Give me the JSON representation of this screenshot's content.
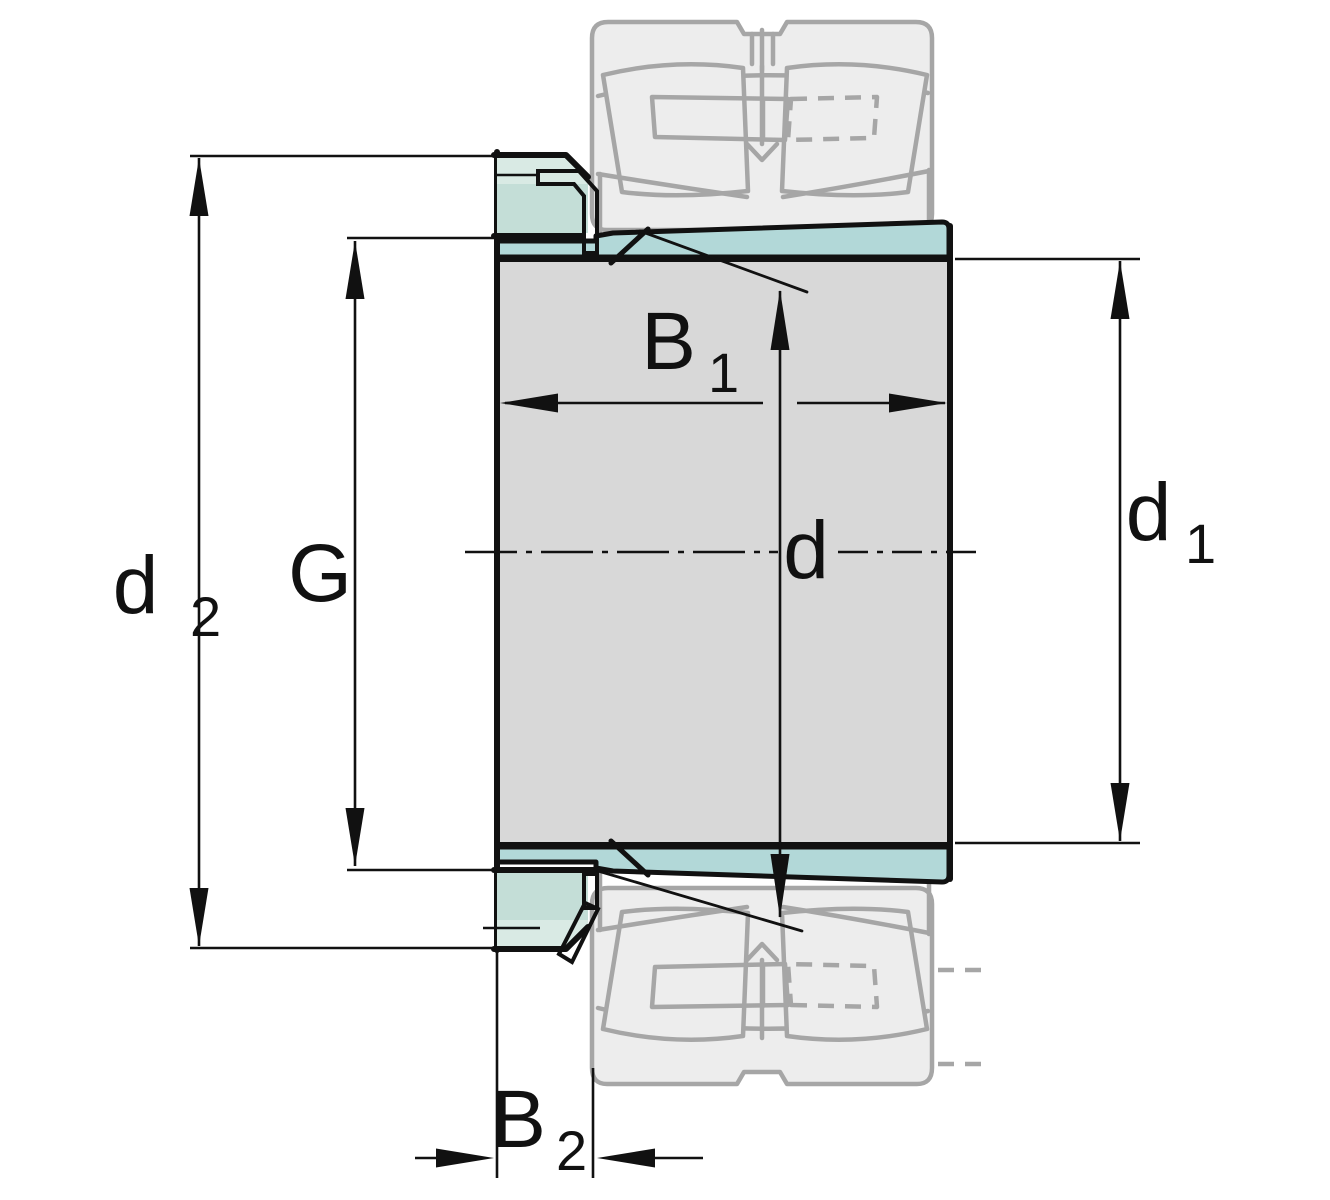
{
  "drawing": {
    "title": "Adapter sleeve with lock nut, lock washer and spherical roller bearing - dimension drawing",
    "colors": {
      "body_gray": "#d8d8d8",
      "sleeve_teal": "#b2d8d8",
      "nut_pale": "#d9eae4",
      "nut_deep": "#c4ded7",
      "washer_white": "#f5faf8",
      "washer_tab_teal": "#bfe0e0",
      "ghost_gray": "#a6a6a6",
      "ghost_fill": "#ededed",
      "line_black": "#111111"
    },
    "labels": {
      "d2": {
        "base": "d",
        "sub": "2"
      },
      "g": {
        "base": "G",
        "sub": ""
      },
      "b1": {
        "base": "B",
        "sub": "1"
      },
      "d": {
        "base": "d",
        "sub": ""
      },
      "d1": {
        "base": "d",
        "sub": "1"
      },
      "b2": {
        "base": "B",
        "sub": "2"
      }
    }
  }
}
